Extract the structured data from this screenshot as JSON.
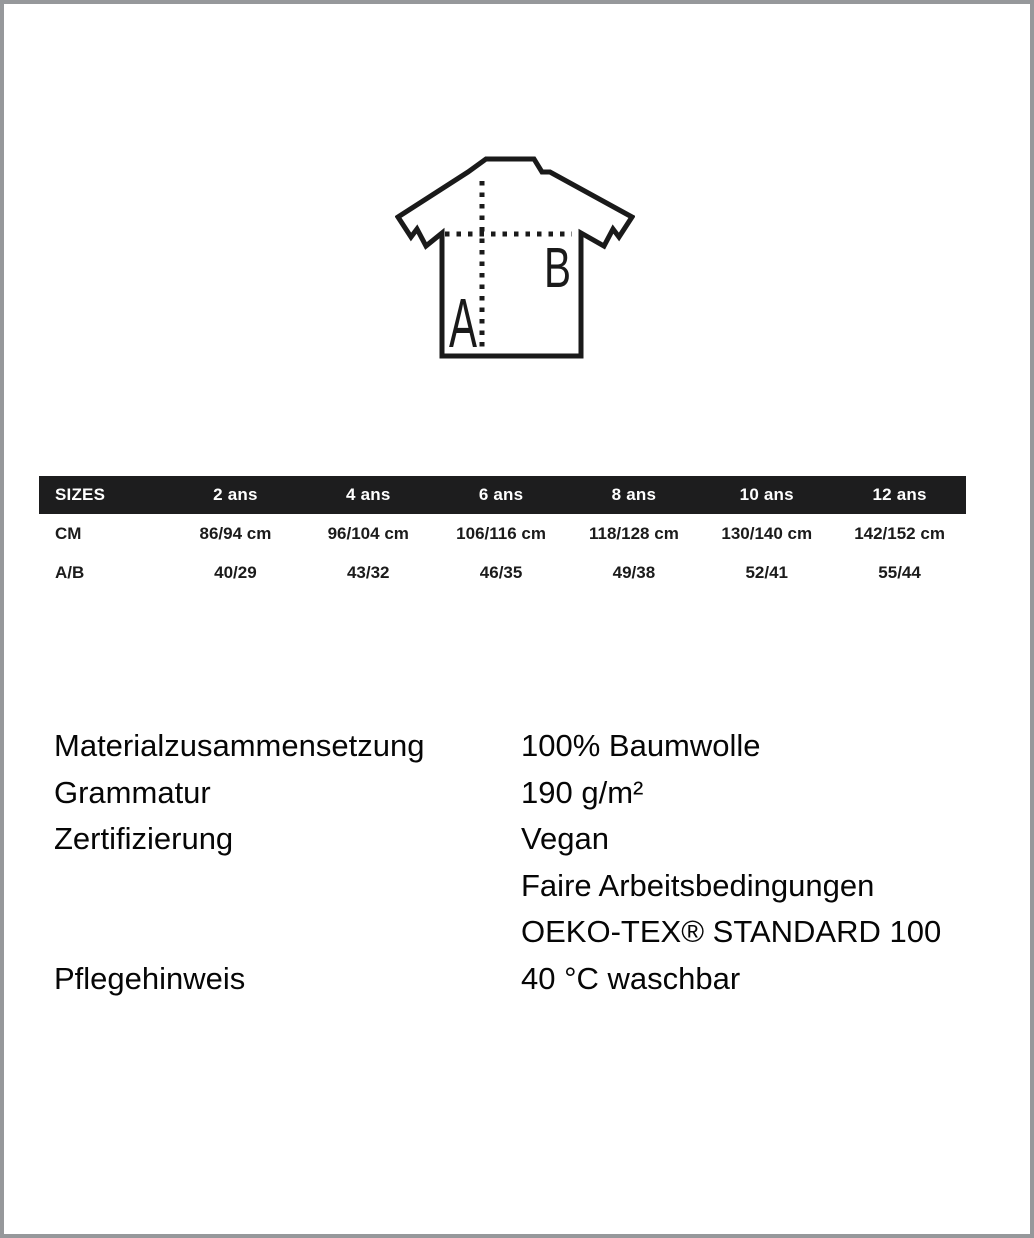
{
  "diagram": {
    "label_a": "A",
    "label_b": "B"
  },
  "size_table": {
    "header": [
      "SIZES",
      "2 ans",
      "4 ans",
      "6 ans",
      "8 ans",
      "10 ans",
      "12 ans"
    ],
    "rows": [
      {
        "label": "CM",
        "values": [
          "86/94 cm",
          "96/104 cm",
          "106/116 cm",
          "118/128 cm",
          "130/140 cm",
          "142/152 cm"
        ]
      },
      {
        "label": "A/B",
        "values": [
          "40/29",
          "43/32",
          "46/35",
          "49/38",
          "52/41",
          "55/44"
        ]
      }
    ],
    "header_bg": "#1d1d1e",
    "header_text_color": "#ffffff"
  },
  "product_info": {
    "rows": [
      {
        "label": "Materialzusammensetzung",
        "values": [
          "100% Baumwolle"
        ]
      },
      {
        "label": "Grammatur",
        "values": [
          "190 g/m²"
        ]
      },
      {
        "label": "Zertifizierung",
        "values": [
          "Vegan",
          "Faire Arbeitsbedingungen",
          "OEKO-TEX® STANDARD 100"
        ]
      },
      {
        "label": "Pflegehinweis",
        "values": [
          "40 °C waschbar"
        ]
      }
    ]
  }
}
